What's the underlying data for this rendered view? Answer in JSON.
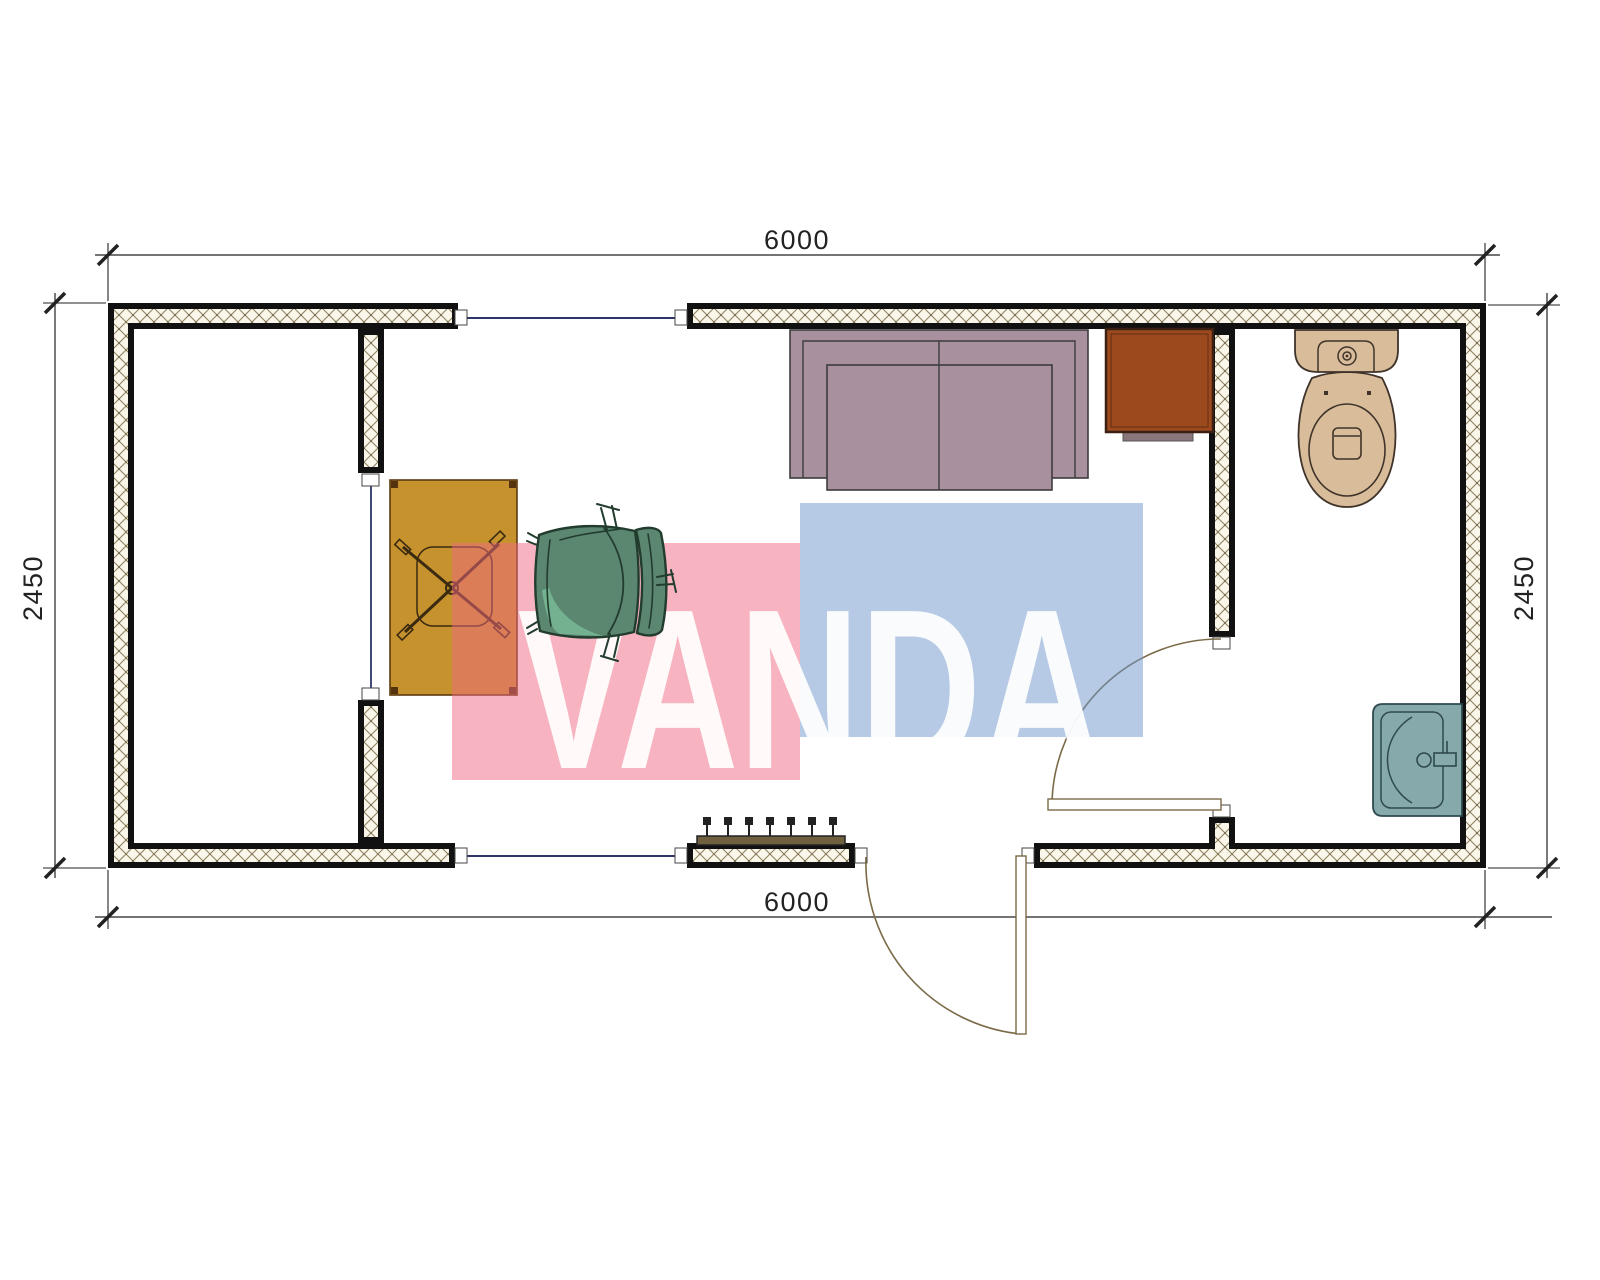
{
  "drawing": {
    "watermark": {
      "text": "VANDA"
    },
    "dimensions": {
      "top": "6000",
      "bottom": "6000",
      "left": "2450",
      "right": "2450"
    }
  },
  "colors": {
    "wall_border": "#111111",
    "hatch_line": "#8f8264",
    "hatch_bg": "#faf6ea",
    "glazing": "#2e3566",
    "door_swing": "#7a6a47",
    "dimension": "#222222",
    "watermark_pink": "#ef6780",
    "watermark_blue": "#6d95cc",
    "watermark_text": "#ffffff",
    "sofa": "#a8909e",
    "sofa_outline": "#3c3c3c",
    "cabinet": "#9c4a1d",
    "cabinet_outline": "#3a2013",
    "cabinet_step": "#8a757c",
    "desk": "#c6922e",
    "desk_outline": "#5a3a10",
    "chair_seat": "#5b8770",
    "chair_highlight": "#73b190",
    "chair_outline": "#223c2d",
    "toilet": "#d9bd9b",
    "toilet_outline": "#3f332a",
    "sink": "#86a9ac",
    "sink_outline": "#2e4a4e",
    "radiator": "#6f6040"
  }
}
